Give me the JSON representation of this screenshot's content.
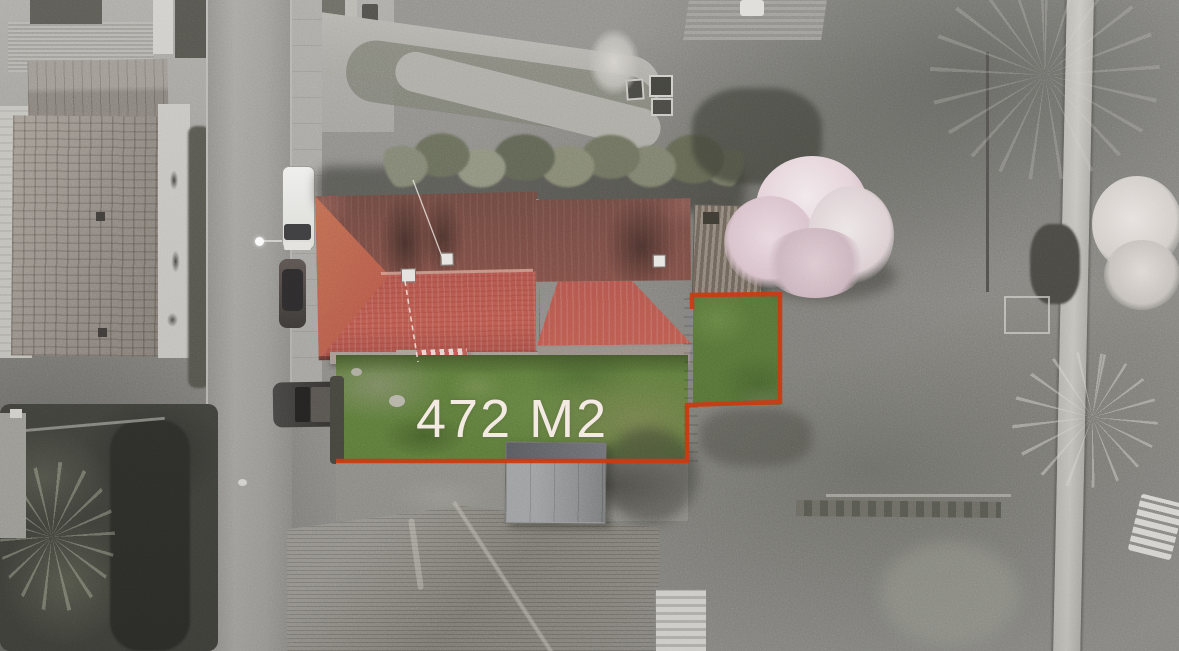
{
  "overlay": {
    "area_text": "472 M2",
    "boundary_points": "692,309 692,295 780,294 780,402 687,405 687,461 336,461",
    "wire_dashed_points": "405,281 418,362",
    "antenna_points": "443,259 413,180"
  },
  "colors": {
    "boundary-red": "#cb3a12",
    "label-white": "#f3eae3",
    "roof-red-bright": "#c05a4e",
    "roof-red-dark": "#74493f",
    "lawn-green": "#5d7c3a",
    "blossom-pink": "#e7d2d8",
    "road-gray": "#9c9b97",
    "photo-gray": "#8d8c88"
  }
}
